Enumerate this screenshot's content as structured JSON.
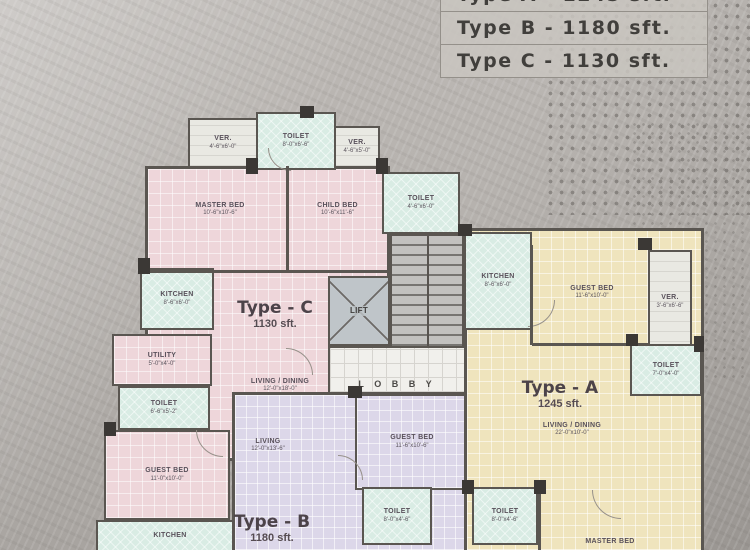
{
  "legend": {
    "rows": [
      "Type A - 1245 sft.",
      "Type B - 1180 sft.",
      "Type C - 1130 sft."
    ]
  },
  "units": {
    "a": {
      "name": "Type - A",
      "area": "1245 sft."
    },
    "b": {
      "name": "Type - B",
      "area": "1180 sft."
    },
    "c": {
      "name": "Type - C",
      "area": "1130 sft."
    }
  },
  "core": {
    "lift": "LIFT",
    "lobby": "L O B B Y"
  },
  "rooms": {
    "ver_top_left": {
      "name": "VER.",
      "dims": "4'-6\"x6'-0\""
    },
    "toilet_top": {
      "name": "TOILET",
      "dims": "8'-0\"x6'-6\""
    },
    "ver_top_right": {
      "name": "VER.",
      "dims": "4'-6\"x5'-0\""
    },
    "master_bed_c": {
      "name": "MASTER BED",
      "dims": "10'-6\"x10'-6\""
    },
    "child_bed_c": {
      "name": "CHILD BED",
      "dims": "10'-6\"x11'-6\""
    },
    "kitchen_c": {
      "name": "KITCHEN",
      "dims": "8'-6\"x6'-0\""
    },
    "utility_c": {
      "name": "UTILITY",
      "dims": "5'-0\"x4'-0\""
    },
    "toilet_c": {
      "name": "TOILET",
      "dims": "6'-6\"x5'-2\""
    },
    "living_dining_c": {
      "name": "LIVING / DINING",
      "dims": "12'-0\"x18'-0\""
    },
    "toilet_mid": {
      "name": "TOILET",
      "dims": "4'-6\"x6'-0\""
    },
    "kitchen_a": {
      "name": "KITCHEN",
      "dims": "8'-6\"x6'-0\""
    },
    "guest_bed_a": {
      "name": "GUEST BED",
      "dims": "11'-6\"x10'-0\""
    },
    "ver_a": {
      "name": "VER.",
      "dims": "3'-6\"x6'-6\""
    },
    "toilet_a_right": {
      "name": "TOILET",
      "dims": "7'-0\"x4'-0\""
    },
    "living_dining_a": {
      "name": "LIVING / DINING",
      "dims": "22'-0\"x10'-0\""
    },
    "toilet_a_bottom": {
      "name": "TOILET",
      "dims": "8'-0\"x4'-6\""
    },
    "master_bed_a": {
      "name": "MASTER BED",
      "dims": ""
    },
    "guest_bed_b": {
      "name": "GUEST BED",
      "dims": "11'-6\"x10'-6\""
    },
    "living_b": {
      "name": "LIVING",
      "dims": "12'-0\"x13'-6\""
    },
    "toilet_b": {
      "name": "TOILET",
      "dims": "8'-0\"x4'-6\""
    },
    "guest_bed_bl": {
      "name": "GUEST BED",
      "dims": "11'-0\"x10'-0\""
    },
    "kitchen_bl": {
      "name": "KITCHEN",
      "dims": ""
    }
  },
  "colors": {
    "type_a_fill": "#efe4bd",
    "type_b_fill": "#dcd7e9",
    "type_c_fill": "#eed6da",
    "wet_room_fill": "#d9ece4",
    "wall": "#5a5651",
    "background": "#b3afab",
    "legend_fill": "#c9c5c0"
  }
}
